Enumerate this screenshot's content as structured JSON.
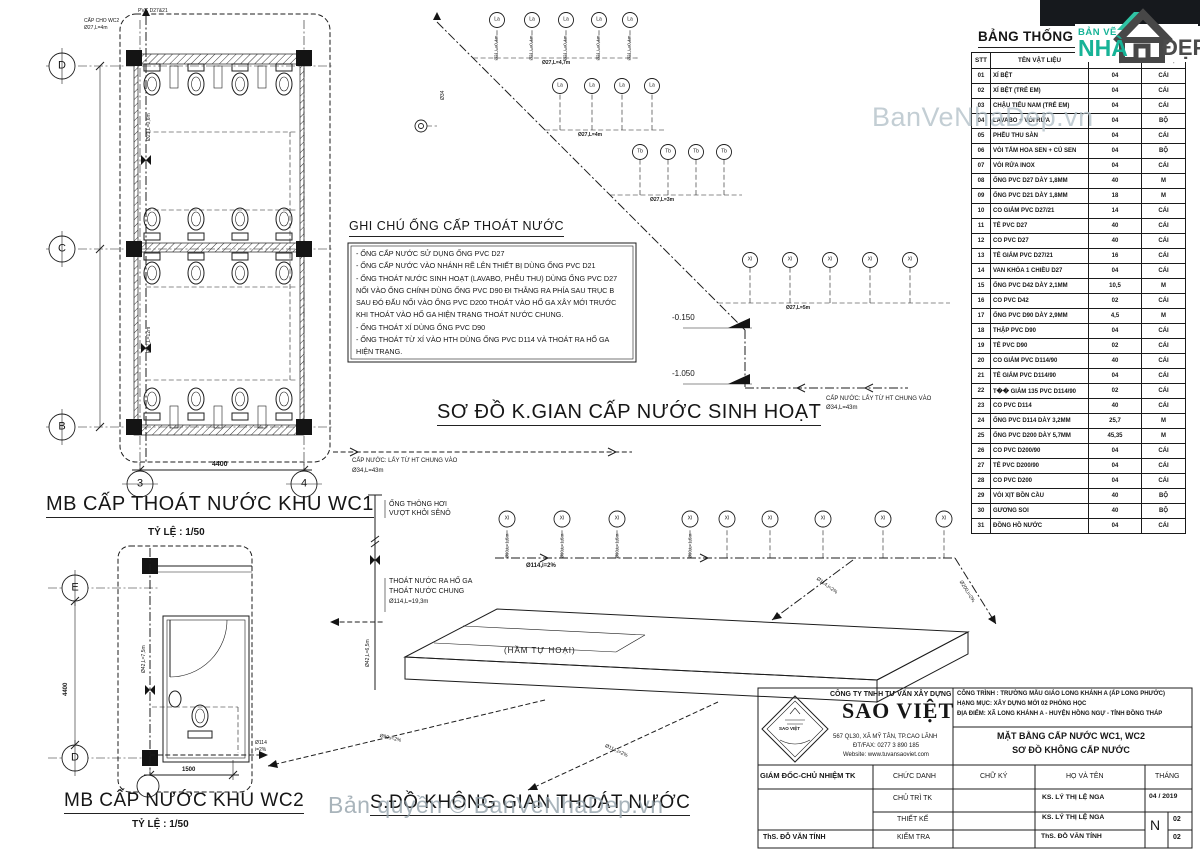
{
  "watermarks": {
    "top": "BanVeNhaDep.vn",
    "bottom": "Bản quyền © BanVeNhaDep.vn"
  },
  "brand": {
    "line1": "BẢN VẼ",
    "line2": "NHÀ",
    "line3": "ĐẸP"
  },
  "materials_table": {
    "title": "BẢNG THỐNG KÊ VẬT LIỆU",
    "headers": [
      "STT",
      "TÊN VẬT LIỆU",
      "SỐ LƯỢNG",
      "ĐƠN VỊ"
    ],
    "rows": [
      [
        "01",
        "XÍ BỆT",
        "04",
        "CÁI"
      ],
      [
        "02",
        "XÍ BỆT (TRẺ EM)",
        "04",
        "CÁI"
      ],
      [
        "03",
        "CHẬU TIỂU NAM (TRẺ EM)",
        "04",
        "CÁI"
      ],
      [
        "04",
        "LAVABO + VÒI RỬA",
        "04",
        "BỘ"
      ],
      [
        "05",
        "PHỄU THU SÀN",
        "04",
        "CÁI"
      ],
      [
        "06",
        "VÒI TẮM HOA SEN + CỦ SEN",
        "04",
        "BỘ"
      ],
      [
        "07",
        "VÒI RỬA INOX",
        "04",
        "CÁI"
      ],
      [
        "08",
        "ỐNG PVC D27 DÀY 1,8MM",
        "40",
        "M"
      ],
      [
        "09",
        "ỐNG PVC D21 DÀY 1,8MM",
        "18",
        "M"
      ],
      [
        "10",
        "CO GIẢM PVC D27/21",
        "14",
        "CÁI"
      ],
      [
        "11",
        "TÊ PVC D27",
        "40",
        "CÁI"
      ],
      [
        "12",
        "CO PVC D27",
        "40",
        "CÁI"
      ],
      [
        "13",
        "TÊ GIẢM PVC D27/21",
        "16",
        "CÁI"
      ],
      [
        "14",
        "VAN KHÓA 1 CHIỀU D27",
        "04",
        "CÁI"
      ],
      [
        "15",
        "ỐNG PVC D42 DÀY 2,1MM",
        "10,5",
        "M"
      ],
      [
        "16",
        "CO PVC D42",
        "02",
        "CÁI"
      ],
      [
        "17",
        "ỐNG PVC D90 DÀY 2,9MM",
        "4,5",
        "M"
      ],
      [
        "18",
        "THẬP PVC D90",
        "04",
        "CÁI"
      ],
      [
        "19",
        "TÊ PVC D90",
        "02",
        "CÁI"
      ],
      [
        "20",
        "CO GIẢM PVC D114/90",
        "40",
        "CÁI"
      ],
      [
        "21",
        "TÊ GIẢM PVC D114/90",
        "04",
        "CÁI"
      ],
      [
        "22",
        "T�� GIẢM 135 PVC D114/90",
        "02",
        "CÁI"
      ],
      [
        "23",
        "CO PVC D114",
        "40",
        "CÁI"
      ],
      [
        "24",
        "ỐNG PVC D114 DÀY 3,2MM",
        "25,7",
        "M"
      ],
      [
        "25",
        "ỐNG PVC D200 DÀY 5,7MM",
        "45,35",
        "M"
      ],
      [
        "26",
        "CO PVC D200/90",
        "04",
        "CÁI"
      ],
      [
        "27",
        "TÊ PVC D200/90",
        "04",
        "CÁI"
      ],
      [
        "28",
        "CO PVC D200",
        "04",
        "CÁI"
      ],
      [
        "29",
        "VÒI XỊT BỒN CẦU",
        "40",
        "BỘ"
      ],
      [
        "30",
        "GƯƠNG SOI",
        "40",
        "BỘ"
      ],
      [
        "31",
        "ĐỒNG HỒ NƯỚC",
        "04",
        "CÁI"
      ]
    ]
  },
  "notes": {
    "title": "GHI CHÚ ỐNG CẤP THOÁT NƯỚC",
    "lines": [
      "- ỐNG CẤP NƯỚC SỬ DỤNG ỐNG PVC D27",
      "- ỐNG CẤP NƯỚC VÀO NHÁNH RẼ LÊN THIẾT BỊ DÙNG ỐNG PVC D21",
      "- ỐNG THOÁT NƯỚC SINH HOẠT (LAVABO, PHỄU THU) DÙNG ỐNG PVC D27",
      "NỐI VÀO ỐNG CHÍNH DÙNG ỐNG PVC D90 ĐI THẲNG RA PHÍA SAU TRỤC B",
      "SAU ĐÓ ĐẤU NỐI VÀO ỐNG PVC D200 THOÁT VÀO HỐ GA XÂY MỚI TRƯỚC",
      "KHI THOÁT VÀO HỐ GA HIỆN TRẠNG THOÁT NƯỚC CHUNG.",
      "- ỐNG THOÁT XÍ DÙNG ỐNG PVC D90",
      "- ỐNG THOÁT TỪ XÍ VÀO HTH DÙNG ỐNG PVC D114 VÀ THOÁT RA HỐ GA",
      "HIỆN TRẠNG."
    ]
  },
  "titles": {
    "wc1": "MB CẤP THOÁT NƯỚC KHU WC1",
    "wc1_scale": "TỶ LỆ : 1/50",
    "wc2": "MB CẤP NƯỚC KHU WC2",
    "wc2_scale": "TỶ LỆ : 1/50",
    "supply": "SƠ ĐỒ K.GIAN CẤP NƯỚC SINH HOẠT",
    "drain": "S.ĐỒ KHÔNG GIAN THOÁT NƯỚC"
  },
  "grid": {
    "d": "D",
    "c": "C",
    "b": "B",
    "n3": "3",
    "n4": "4",
    "e": "E",
    "d2": "D"
  },
  "dims": {
    "wc1_w": "4400",
    "wc2_w": "1500",
    "wc2_h": "4400"
  },
  "levels": {
    "lv1": "-0.150",
    "lv2": "-1.050"
  },
  "fixtures": {
    "la": "La",
    "tb": "Tb",
    "xi": "XI"
  },
  "pipe": {
    "source_text": "CẤP NƯỚC: LẤY TỪ HT CHUNG VÀO",
    "source_size": "Ø34,L=43m",
    "riser_supply": "Ø21,L=0,4m",
    "riser_drain": "Ø90,L=1,5m",
    "b1": "Ø27,L=4,7m",
    "b2": "Ø27,L=4m",
    "b3": "Ø27,L=3m",
    "b4": "Ø27,L=5m",
    "main_drain": "Ø114,i=2%",
    "diag1": "Ø114,i=2%",
    "diag2": "Ø200,i=2%",
    "below1": "Ø90,i=2%",
    "below2": "Ø114,i=2%",
    "vent_v": "Ø42,L=6,5m",
    "main_v": "Ø34",
    "wc1_top1": "CẤP CHO WC2",
    "wc1_top2": "Ø27,L=4m",
    "wc1_v1": "Ø27,L=12m",
    "wc1_v2": "Ø21,L=0,6m",
    "wc2_exit1": "Ø114",
    "wc2_exit2": "i=2%",
    "wc2_v": "Ø42,L=7,5m",
    "mini_top": "PVC D27&21"
  },
  "drain_labels": {
    "vent1": "ỐNG THÔNG HƠI",
    "vent2": "VƯỢT KHỎI SÊNÔ",
    "out1": "THOÁT NƯỚC RA HỐ GA",
    "out2": "THOÁT NƯỚC CHUNG",
    "out3": "Ø114,L=19,3m",
    "septic": "(HẦM TỰ HOẠI)"
  },
  "titleblock": {
    "company": {
      "line1": "CÔNG TY TNHH TƯ VẤN XÂY DỰNG",
      "name": "SAO VIỆT",
      "badge": "SAO VIỆT",
      "addr1": "567 QL30, XÃ MỸ TÂN, TP.CAO LÃNH",
      "addr2": "ĐT/FAX: 0277 3 890 185",
      "addr3": "Website: www.tuvansaoviet.com"
    },
    "project": {
      "line1": "CÔNG TRÌNH : TRƯỜNG MẪU GIÁO LONG KHÁNH A (ẤP LONG PHƯỚC)",
      "line2": "HẠNG MỤC: XÂY DỰNG MỚI 02 PHÒNG HỌC",
      "line3": "ĐỊA ĐIỂM:  XÃ LONG KHÁNH A - HUYỆN HỒNG NGỰ - TỈNH ĐỒNG THÁP"
    },
    "drawing": {
      "line1": "MẶT BẰNG CẤP NƯỚC WC1, WC2",
      "line2": "SƠ ĐỒ KHÔNG CẤP NƯỚC"
    },
    "cols": {
      "c1": "GIÁM ĐỐC-CHỦ NHIỆM TK",
      "c2": "CHỨC DANH",
      "c3": "CHỮ KÝ",
      "c4": "HỌ VÀ TÊN",
      "c5": "THÁNG"
    },
    "rows": {
      "r1_role": "CHỦ TRÌ TK",
      "r1_name": "KS. LÝ THỊ LỆ NGA",
      "r1_month": "04 / 2019",
      "r2_role": "THIẾT KẾ",
      "r2_name": "KS. LÝ THỊ LỆ NGA",
      "r3_role": "KIỂM TRA",
      "r3_name": "ThS. ĐỖ VĂN TÍNH",
      "left_name": "ThS. ĐỖ VĂN TÍNH"
    },
    "sheet": {
      "letter": "N",
      "n1": "02",
      "n2": "02"
    }
  }
}
